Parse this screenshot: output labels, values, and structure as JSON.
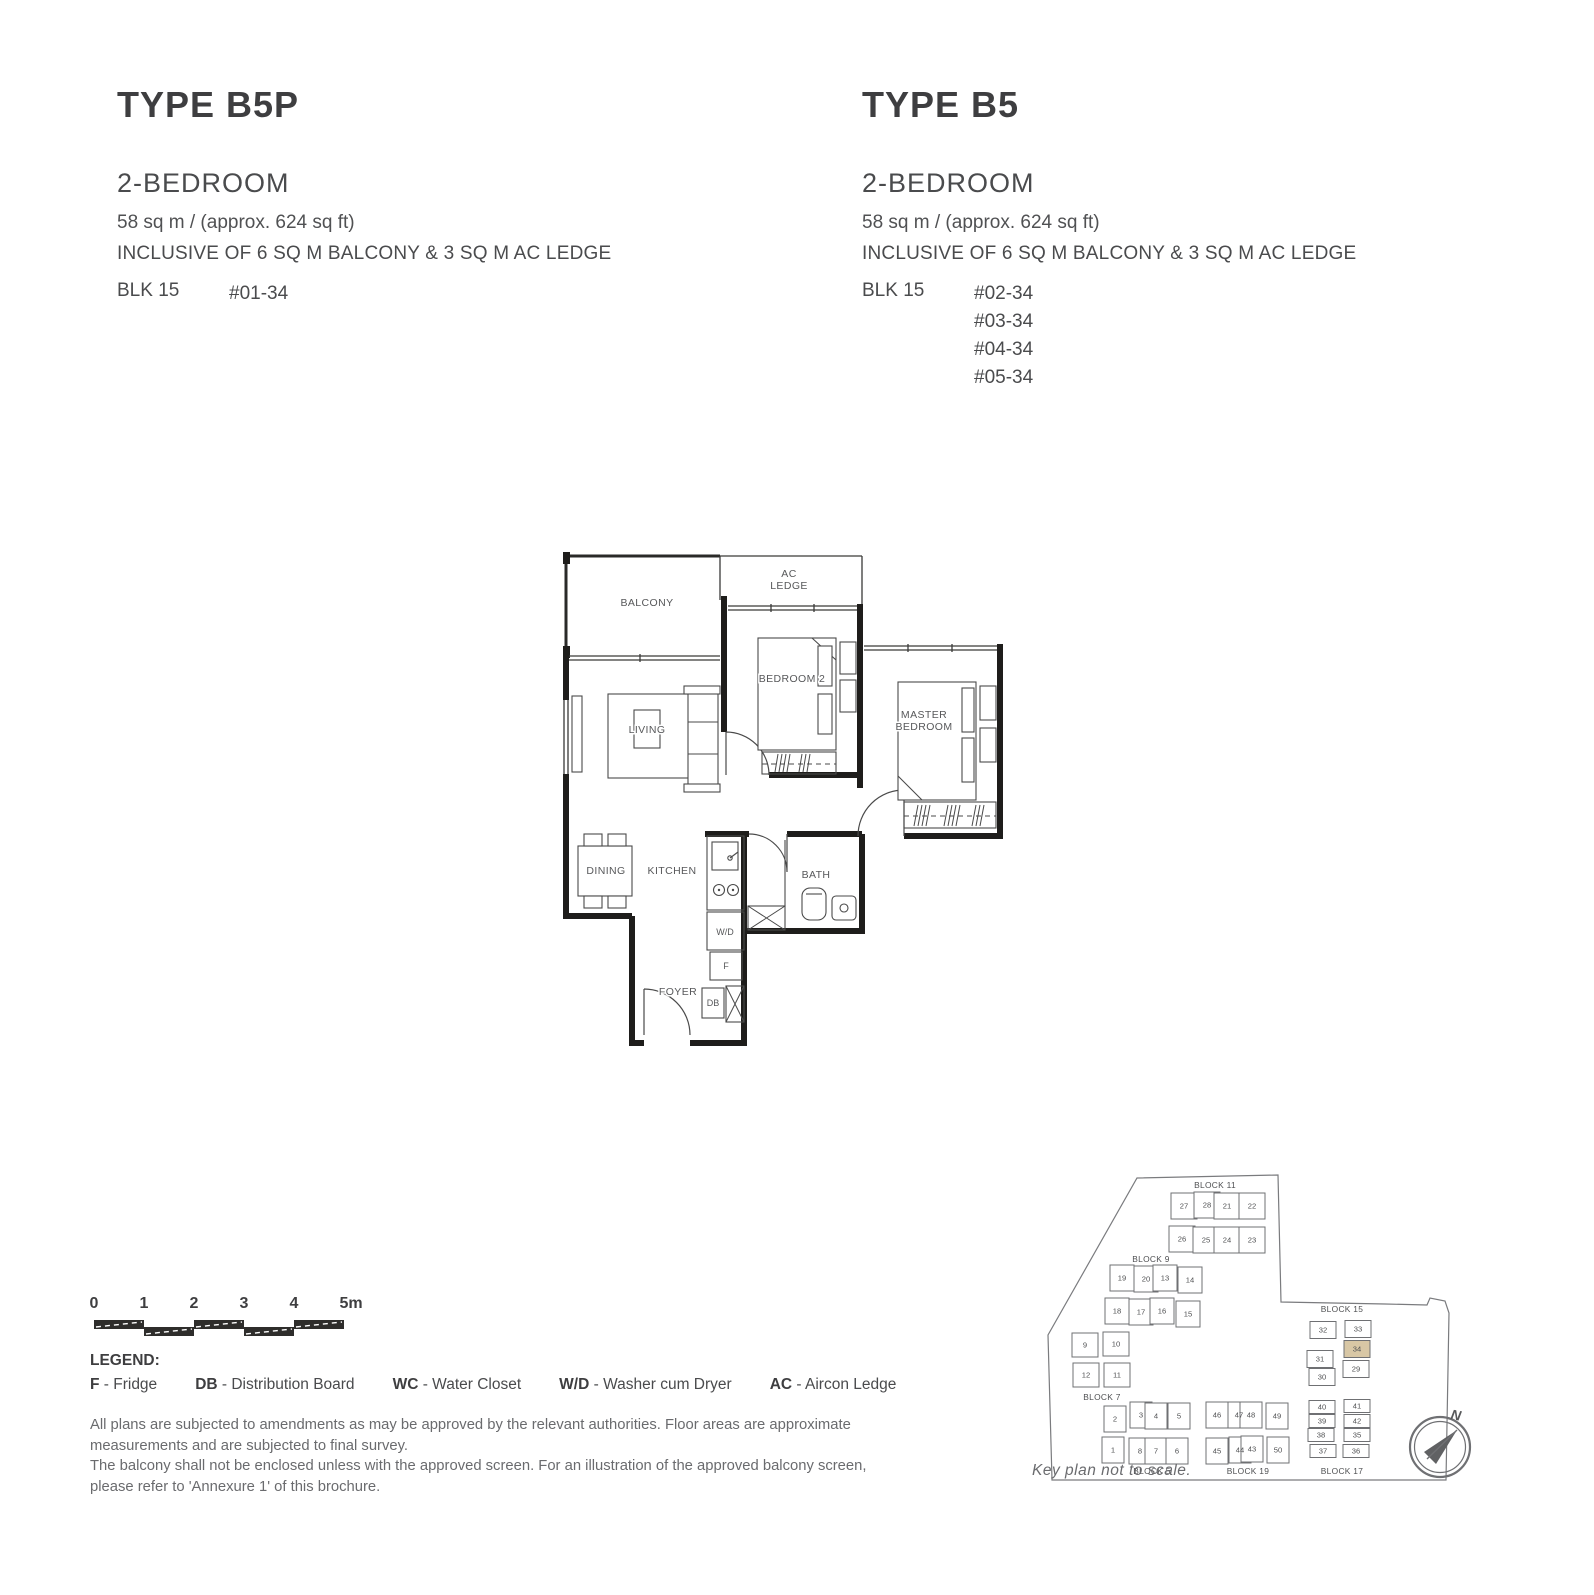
{
  "units": {
    "left": {
      "title": "TYPE B5P",
      "bedroom": "2-BEDROOM",
      "area": "58 sq m / (approx. 624 sq ft)",
      "inclusive": "INCLUSIVE OF 6 SQ M BALCONY & 3 SQ M AC LEDGE",
      "block": "BLK 15",
      "stacks": [
        "#01-34"
      ]
    },
    "right": {
      "title": "TYPE B5",
      "bedroom": "2-BEDROOM",
      "area": "58 sq m / (approx. 624 sq ft)",
      "inclusive": "INCLUSIVE OF 6 SQ M BALCONY & 3 SQ M AC LEDGE",
      "block": "BLK 15",
      "stacks": [
        "#02-34",
        "#03-34",
        "#04-34",
        "#05-34"
      ]
    }
  },
  "floorplan": {
    "labels": {
      "balcony": "BALCONY",
      "ac1": "AC",
      "ac2": "LEDGE",
      "bedroom2": "BEDROOM 2",
      "master1": "MASTER",
      "master2": "BEDROOM",
      "living": "LIVING",
      "dining": "DINING",
      "kitchen": "KITCHEN",
      "bath": "BATH",
      "wd": "W/D",
      "fridge": "F",
      "foyer": "FOYER",
      "db": "DB"
    }
  },
  "scalebar": {
    "ticks": [
      "0",
      "1",
      "2",
      "3",
      "4",
      "5m"
    ]
  },
  "legend": {
    "title": "LEGEND:",
    "items": [
      {
        "abbr": "F",
        "rest": " - Fridge"
      },
      {
        "abbr": "DB",
        "rest": " - Distribution Board"
      },
      {
        "abbr": "WC",
        "rest": " - Water Closet"
      },
      {
        "abbr": "W/D",
        "rest": " - Washer cum Dryer"
      },
      {
        "abbr": "AC",
        "rest": " - Aircon Ledge"
      }
    ]
  },
  "disclaimer": {
    "para1": "All plans are subjected to amendments as may be approved by the relevant authorities. Floor areas are approximate measurements and are subjected to final survey.",
    "para2": "The balcony shall not be enclosed unless with the approved screen. For an illustration of the approved balcony screen, please refer to 'Annexure 1' of this brochure."
  },
  "keyplan": {
    "caption": "Key plan not to scale.",
    "compass": "N",
    "highlight_unit": "34",
    "highlight_color": "#d8c7a5",
    "blocks": [
      {
        "name": "BLOCK 11",
        "lx": 190,
        "ly": 40,
        "w": 26,
        "h": 26,
        "units": [
          {
            "n": "27",
            "x": 159,
            "y": 58
          },
          {
            "n": "28",
            "x": 182,
            "y": 57
          },
          {
            "n": "21",
            "x": 202,
            "y": 58
          },
          {
            "n": "22",
            "x": 227,
            "y": 58
          },
          {
            "n": "26",
            "x": 157,
            "y": 91
          },
          {
            "n": "25",
            "x": 181,
            "y": 92
          },
          {
            "n": "24",
            "x": 202,
            "y": 92
          },
          {
            "n": "23",
            "x": 227,
            "y": 92
          }
        ]
      },
      {
        "name": "BLOCK 9",
        "lx": 126,
        "ly": 114,
        "w": 24,
        "h": 26,
        "units": [
          {
            "n": "19",
            "x": 97,
            "y": 130
          },
          {
            "n": "20",
            "x": 121,
            "y": 131
          },
          {
            "n": "13",
            "x": 140,
            "y": 130
          },
          {
            "n": "14",
            "x": 165,
            "y": 132
          },
          {
            "n": "18",
            "x": 92,
            "y": 163
          },
          {
            "n": "17",
            "x": 116,
            "y": 164
          },
          {
            "n": "16",
            "x": 137,
            "y": 163
          },
          {
            "n": "15",
            "x": 163,
            "y": 166
          }
        ]
      },
      {
        "name": "BLOCK 7",
        "lx": 77,
        "ly": 252,
        "w": 26,
        "h": 24,
        "units": [
          {
            "n": "9",
            "x": 60,
            "y": 197
          },
          {
            "n": "10",
            "x": 91,
            "y": 196
          },
          {
            "n": "12",
            "x": 61,
            "y": 227
          },
          {
            "n": "11",
            "x": 92,
            "y": 227
          }
        ]
      },
      {
        "name": "BLOCK 5",
        "lx": 127,
        "ly": 326,
        "w": 22,
        "h": 26,
        "units": [
          {
            "n": "2",
            "x": 90,
            "y": 271
          },
          {
            "n": "3",
            "x": 116,
            "y": 267
          },
          {
            "n": "4",
            "x": 131,
            "y": 268
          },
          {
            "n": "5",
            "x": 154,
            "y": 268
          },
          {
            "n": "1",
            "x": 88,
            "y": 302
          },
          {
            "n": "8",
            "x": 115,
            "y": 303
          },
          {
            "n": "7",
            "x": 131,
            "y": 303
          },
          {
            "n": "6",
            "x": 152,
            "y": 303
          }
        ]
      },
      {
        "name": "BLOCK 19",
        "lx": 223,
        "ly": 326,
        "w": 22,
        "h": 26,
        "units": [
          {
            "n": "46",
            "x": 192,
            "y": 267
          },
          {
            "n": "47",
            "x": 214,
            "y": 267
          },
          {
            "n": "48",
            "x": 226,
            "y": 267
          },
          {
            "n": "49",
            "x": 252,
            "y": 268
          },
          {
            "n": "45",
            "x": 192,
            "y": 303
          },
          {
            "n": "44",
            "x": 215,
            "y": 302
          },
          {
            "n": "43",
            "x": 227,
            "y": 301
          },
          {
            "n": "50",
            "x": 253,
            "y": 302
          }
        ]
      },
      {
        "name": "BLOCK 15",
        "lx": 317,
        "ly": 164,
        "w": 26,
        "h": 17,
        "units": [
          {
            "n": "32",
            "x": 298,
            "y": 182
          },
          {
            "n": "33",
            "x": 333,
            "y": 181
          },
          {
            "n": "34",
            "x": 332,
            "y": 201
          },
          {
            "n": "31",
            "x": 295,
            "y": 211
          },
          {
            "n": "29",
            "x": 331,
            "y": 221
          },
          {
            "n": "30",
            "x": 297,
            "y": 229
          }
        ]
      },
      {
        "name": "BLOCK 17",
        "lx": 317,
        "ly": 326,
        "w": 26,
        "h": 13,
        "units": [
          {
            "n": "40",
            "x": 297,
            "y": 259
          },
          {
            "n": "41",
            "x": 332,
            "y": 258
          },
          {
            "n": "39",
            "x": 297,
            "y": 273
          },
          {
            "n": "42",
            "x": 332,
            "y": 273
          },
          {
            "n": "38",
            "x": 296,
            "y": 287
          },
          {
            "n": "35",
            "x": 332,
            "y": 287
          },
          {
            "n": "37",
            "x": 298,
            "y": 303
          },
          {
            "n": "36",
            "x": 331,
            "y": 303
          }
        ]
      }
    ]
  }
}
